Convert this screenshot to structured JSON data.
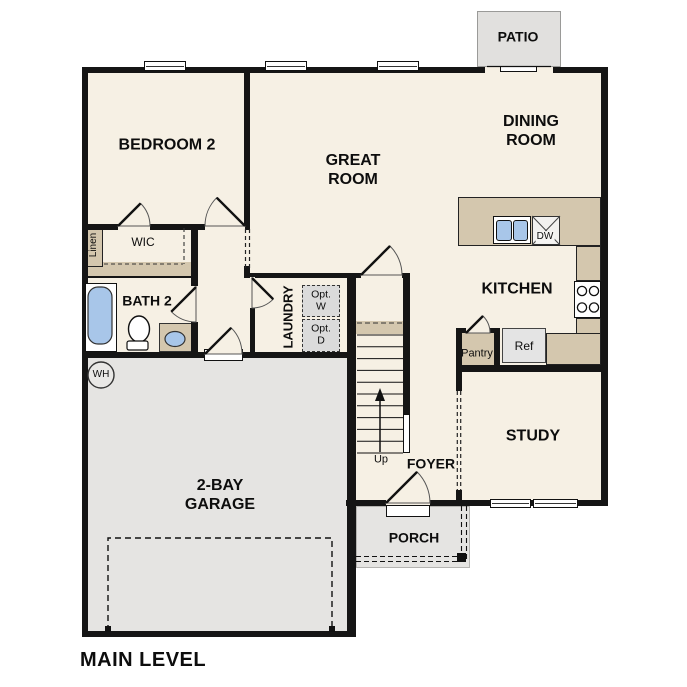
{
  "plan": {
    "level_label": "MAIN LEVEL",
    "rooms": {
      "bedroom2": "BEDROOM 2",
      "great_room": "GREAT ROOM",
      "dining_room": "DINING ROOM",
      "kitchen": "KITCHEN",
      "study": "STUDY",
      "foyer": "FOYER",
      "laundry": "LAUNDRY",
      "bath2": "BATH 2",
      "wic": "WIC",
      "linen": "Linen",
      "pantry": "Pantry",
      "garage": "2-BAY GARAGE",
      "porch": "PORCH",
      "patio": "PATIO"
    },
    "labels": {
      "ref": "Ref",
      "dw": "DW",
      "wh": "WH",
      "opt_washer": "Opt. W",
      "opt_dryer": "Opt. D",
      "stairs_up": "Up"
    },
    "colors": {
      "floor": "#f6f0e4",
      "wall": "#151515",
      "counter_tan": "#d4c7ae",
      "garage_gray": "#e5e4e2",
      "patio_gray": "#e1e0de",
      "fixture_blue": "#a8c6e9",
      "appliance_gray": "#e4e4e4",
      "optional_gray": "#dbdbdb"
    }
  }
}
